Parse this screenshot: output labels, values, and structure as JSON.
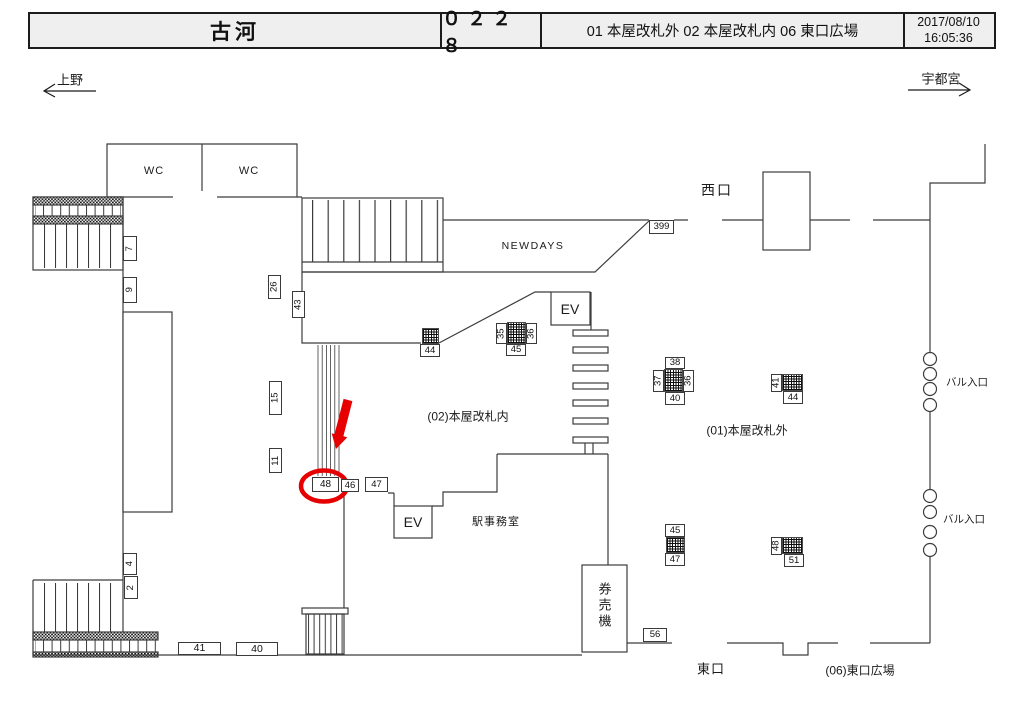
{
  "header": {
    "station": "古河",
    "code": "０２２８",
    "areas": "01 本屋改札外 02 本屋改札内 06 東口広場",
    "date": "2017/08/10",
    "time": "16:05:36"
  },
  "directions": {
    "left": "上野",
    "right": "宇都宮"
  },
  "map": {
    "labels": {
      "wc1": "WC",
      "wc2": "WC",
      "newdays": "NEWDAYS",
      "ev_upper": "EV",
      "ev_lower": "EV",
      "west_exit": "西口",
      "east_exit": "東口",
      "office": "駅事務室",
      "ticket_machines": "券売機",
      "bar_entrance_1": "バル入口",
      "bar_entrance_2": "バル入口",
      "zone_inside": "(02)本屋改札内",
      "zone_outside": "(01)本屋改札外",
      "zone_east_plaza": "(06)東口広場"
    },
    "tags": [
      {
        "id": "t7",
        "v": "7",
        "x": 123,
        "y": 236,
        "w": 14,
        "h": 25,
        "rot": true
      },
      {
        "id": "t9",
        "v": "9",
        "x": 123,
        "y": 277,
        "w": 14,
        "h": 26,
        "rot": true
      },
      {
        "id": "t26",
        "v": "26",
        "x": 268,
        "y": 275,
        "w": 13,
        "h": 24,
        "rot": true
      },
      {
        "id": "t43",
        "v": "43",
        "x": 292,
        "y": 291,
        "w": 13,
        "h": 27,
        "rot": true
      },
      {
        "id": "t15",
        "v": "15",
        "x": 269,
        "y": 381,
        "w": 13,
        "h": 34,
        "rot": true
      },
      {
        "id": "t11",
        "v": "11",
        "x": 269,
        "y": 448,
        "w": 13,
        "h": 25,
        "rot": true
      },
      {
        "id": "t4",
        "v": "4",
        "x": 123,
        "y": 553,
        "w": 14,
        "h": 22,
        "rot": true
      },
      {
        "id": "t2",
        "v": "2",
        "x": 124,
        "y": 576,
        "w": 14,
        "h": 23,
        "rot": true
      },
      {
        "id": "t399",
        "v": "399",
        "x": 649,
        "y": 220,
        "w": 25,
        "h": 14
      },
      {
        "id": "t44a",
        "v": "44",
        "x": 420,
        "y": 344,
        "w": 20,
        "h": 13
      },
      {
        "id": "t35",
        "v": "35",
        "x": 496,
        "y": 323,
        "w": 11,
        "h": 21,
        "rot": true
      },
      {
        "id": "t36a",
        "v": "36",
        "x": 526,
        "y": 323,
        "w": 11,
        "h": 21,
        "rot": true
      },
      {
        "id": "t45a",
        "v": "45",
        "x": 506,
        "y": 344,
        "w": 20,
        "h": 12
      },
      {
        "id": "t38",
        "v": "38",
        "x": 665,
        "y": 357,
        "w": 20,
        "h": 12
      },
      {
        "id": "t37",
        "v": "37",
        "x": 653,
        "y": 370,
        "w": 11,
        "h": 22,
        "rot": true
      },
      {
        "id": "t36b",
        "v": "36",
        "x": 683,
        "y": 370,
        "w": 11,
        "h": 22,
        "rot": true
      },
      {
        "id": "t40a",
        "v": "40",
        "x": 665,
        "y": 392,
        "w": 20,
        "h": 13
      },
      {
        "id": "t41a",
        "v": "41",
        "x": 771,
        "y": 374,
        "w": 11,
        "h": 18,
        "rot": true
      },
      {
        "id": "t44b",
        "v": "44",
        "x": 783,
        "y": 391,
        "w": 20,
        "h": 13
      },
      {
        "id": "t48",
        "v": "48",
        "x": 312,
        "y": 477,
        "w": 27,
        "h": 15,
        "fs": 10
      },
      {
        "id": "t46",
        "v": "46",
        "x": 341,
        "y": 479,
        "w": 18,
        "h": 13
      },
      {
        "id": "t47a",
        "v": "47",
        "x": 365,
        "y": 477,
        "w": 23,
        "h": 15
      },
      {
        "id": "t45b",
        "v": "45",
        "x": 665,
        "y": 524,
        "w": 20,
        "h": 13
      },
      {
        "id": "t47b",
        "v": "47",
        "x": 665,
        "y": 553,
        "w": 20,
        "h": 13
      },
      {
        "id": "t48b",
        "v": "48",
        "x": 771,
        "y": 537,
        "w": 11,
        "h": 18,
        "rot": true
      },
      {
        "id": "t51",
        "v": "51",
        "x": 784,
        "y": 554,
        "w": 20,
        "h": 13
      },
      {
        "id": "t56",
        "v": "56",
        "x": 643,
        "y": 628,
        "w": 24,
        "h": 14
      },
      {
        "id": "t41b",
        "v": "41",
        "x": 178,
        "y": 642,
        "w": 43,
        "h": 13,
        "fs": 10.5
      },
      {
        "id": "t40b",
        "v": "40",
        "x": 236,
        "y": 642,
        "w": 42,
        "h": 14,
        "fs": 10.5
      }
    ],
    "gates": [
      {
        "x": 422,
        "y": 328,
        "w": 17,
        "h": 16
      },
      {
        "x": 507,
        "y": 322,
        "w": 19,
        "h": 22
      },
      {
        "x": 664,
        "y": 369,
        "w": 19,
        "h": 23
      },
      {
        "x": 782,
        "y": 374,
        "w": 21,
        "h": 17
      },
      {
        "x": 666,
        "y": 537,
        "w": 19,
        "h": 16
      },
      {
        "x": 782,
        "y": 537,
        "w": 21,
        "h": 17
      }
    ],
    "highlight": {
      "selected_tag": "48",
      "color": "#e60000"
    }
  }
}
